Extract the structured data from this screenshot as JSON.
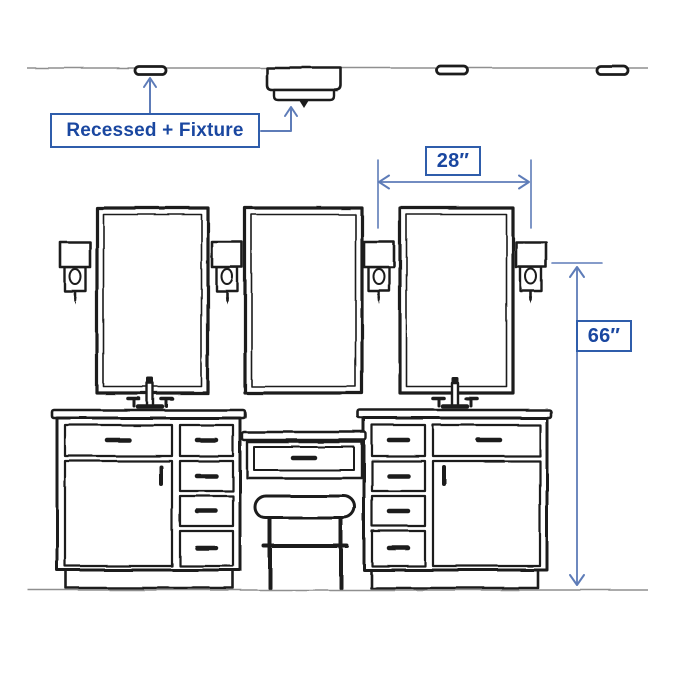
{
  "colors": {
    "background": "#ffffff",
    "line_art": "#1c1c1c",
    "guide_line": "#8f8f8f",
    "annotation_border": "#2f5dab",
    "annotation_text": "#1a47a0",
    "dimension_line": "#5e7cb8"
  },
  "labels": {
    "ceiling": {
      "text": "Recessed + Fixture"
    },
    "width": {
      "value": "28″"
    },
    "height": {
      "value": "66″"
    }
  },
  "scene": {
    "kind": "bathroom-vanity-lighting-diagram",
    "ceiling_items": [
      "recessed-light",
      "flush-mount-fixture",
      "recessed-light",
      "recessed-light"
    ],
    "mirror_count": 3,
    "sconce_count": 4,
    "vanity_cabinet_count": 2,
    "makeup_stool_count": 1
  }
}
